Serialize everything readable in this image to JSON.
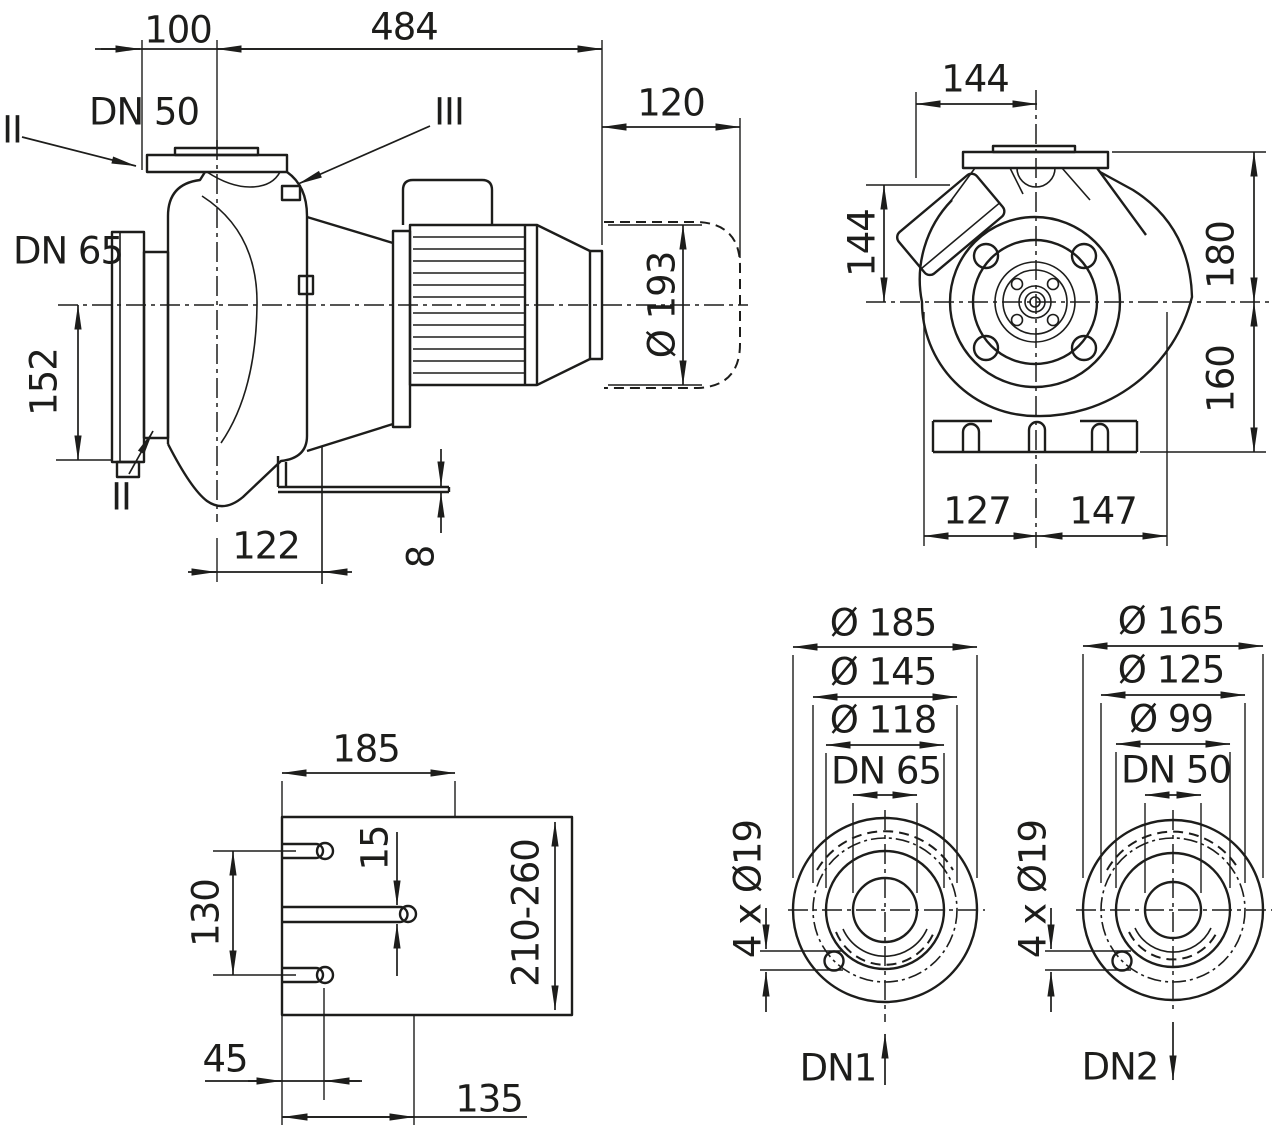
{
  "colors": {
    "line": "#1d1d1b",
    "background": "#ffffff"
  },
  "side": {
    "dim_flange_to_axis": "100",
    "dim_length": "484",
    "dim_module": "120",
    "dn_discharge": "DN 50",
    "dn_suction": "DN 65",
    "dim_axis_to_bottom": "152",
    "dia_motor": "Ø 193",
    "dim_foot_offset": "122",
    "dim_foot_thickness": "8",
    "marker_discharge": "II",
    "marker_vent": "III",
    "marker_drain": "II"
  },
  "front": {
    "dim_top_width": "144",
    "dim_left_height": "144",
    "dim_upper_height": "180",
    "dim_lower_height": "160",
    "dim_foot_left": "127",
    "dim_foot_right": "147"
  },
  "base": {
    "dim_plate_width": "185",
    "dim_slot_spacing": "130",
    "dim_slot_width": "15",
    "dim_length_range": "210-260",
    "dim_slot_pos_outer": "45",
    "dim_slot_pos_middle": "135"
  },
  "flange_dn1": {
    "outer": "Ø 185",
    "bolt_circle": "Ø 145",
    "raised_face": "Ø 118",
    "nominal": "DN 65",
    "bolt_holes": "4 x Ø19",
    "port": "DN1"
  },
  "flange_dn2": {
    "outer": "Ø 165",
    "bolt_circle": "Ø 125",
    "raised_face": "Ø 99",
    "nominal": "DN 50",
    "bolt_holes": "4 x Ø19",
    "port": "DN2"
  }
}
